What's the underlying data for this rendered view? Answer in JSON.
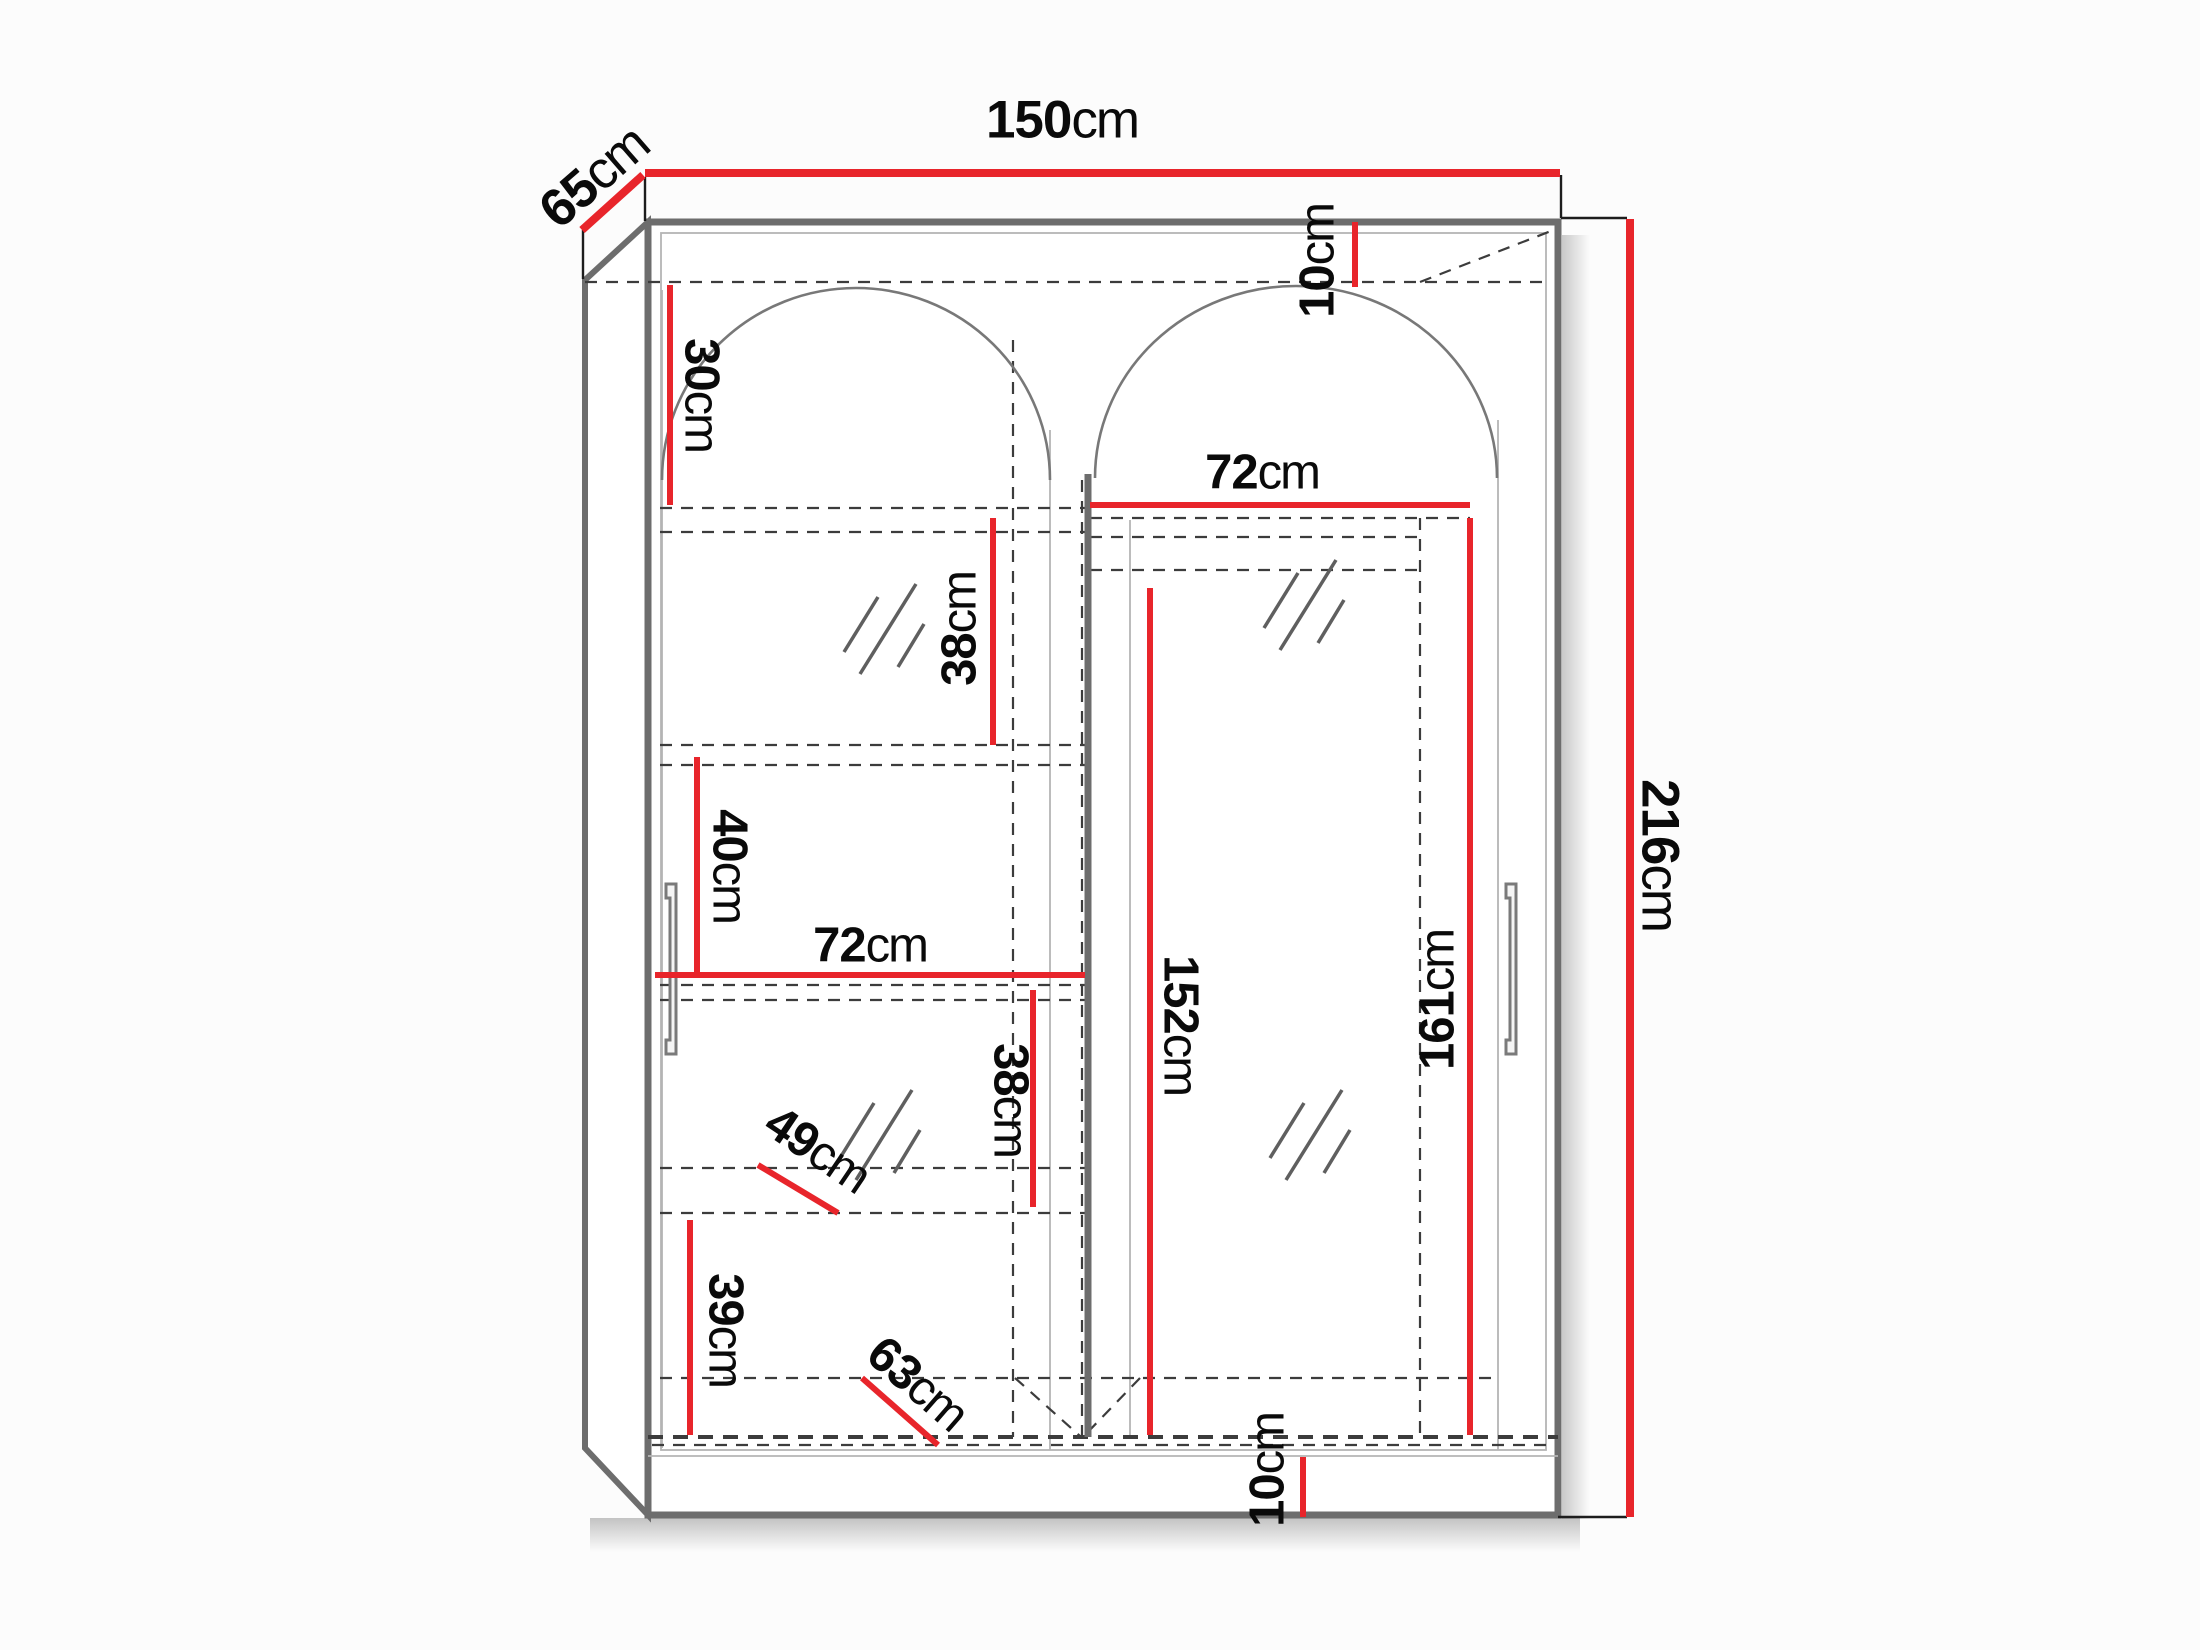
{
  "diagram": {
    "type": "wardrobe-dimension-drawing",
    "unit": "cm",
    "colors": {
      "dimension_line": "#e8252b",
      "outline": "#6d6d6d",
      "dashed": "#3c3c3c",
      "text": "#0a0a0a"
    },
    "dims": {
      "width_top": {
        "value": "150",
        "unit": "cm"
      },
      "depth_top": {
        "value": "65",
        "unit": "cm"
      },
      "height_right": {
        "value": "216",
        "unit": "cm"
      },
      "gap_top": {
        "value": "10",
        "unit": "cm"
      },
      "upper_shelf_height": {
        "value": "30",
        "unit": "cm"
      },
      "section_right_width": {
        "value": "72",
        "unit": "cm"
      },
      "shelf_gap_upper": {
        "value": "38",
        "unit": "cm"
      },
      "shelf_gap_40": {
        "value": "40",
        "unit": "cm"
      },
      "section_left_width": {
        "value": "72",
        "unit": "cm"
      },
      "shelf_gap_lower": {
        "value": "38",
        "unit": "cm"
      },
      "shelf_depth_49": {
        "value": "49",
        "unit": "cm"
      },
      "shelf_gap_39": {
        "value": "39",
        "unit": "cm"
      },
      "shelf_depth_63": {
        "value": "63",
        "unit": "cm"
      },
      "hanging_height_152": {
        "value": "152",
        "unit": "cm"
      },
      "hanging_height_161": {
        "value": "161",
        "unit": "cm"
      },
      "gap_bottom": {
        "value": "10",
        "unit": "cm"
      }
    }
  }
}
